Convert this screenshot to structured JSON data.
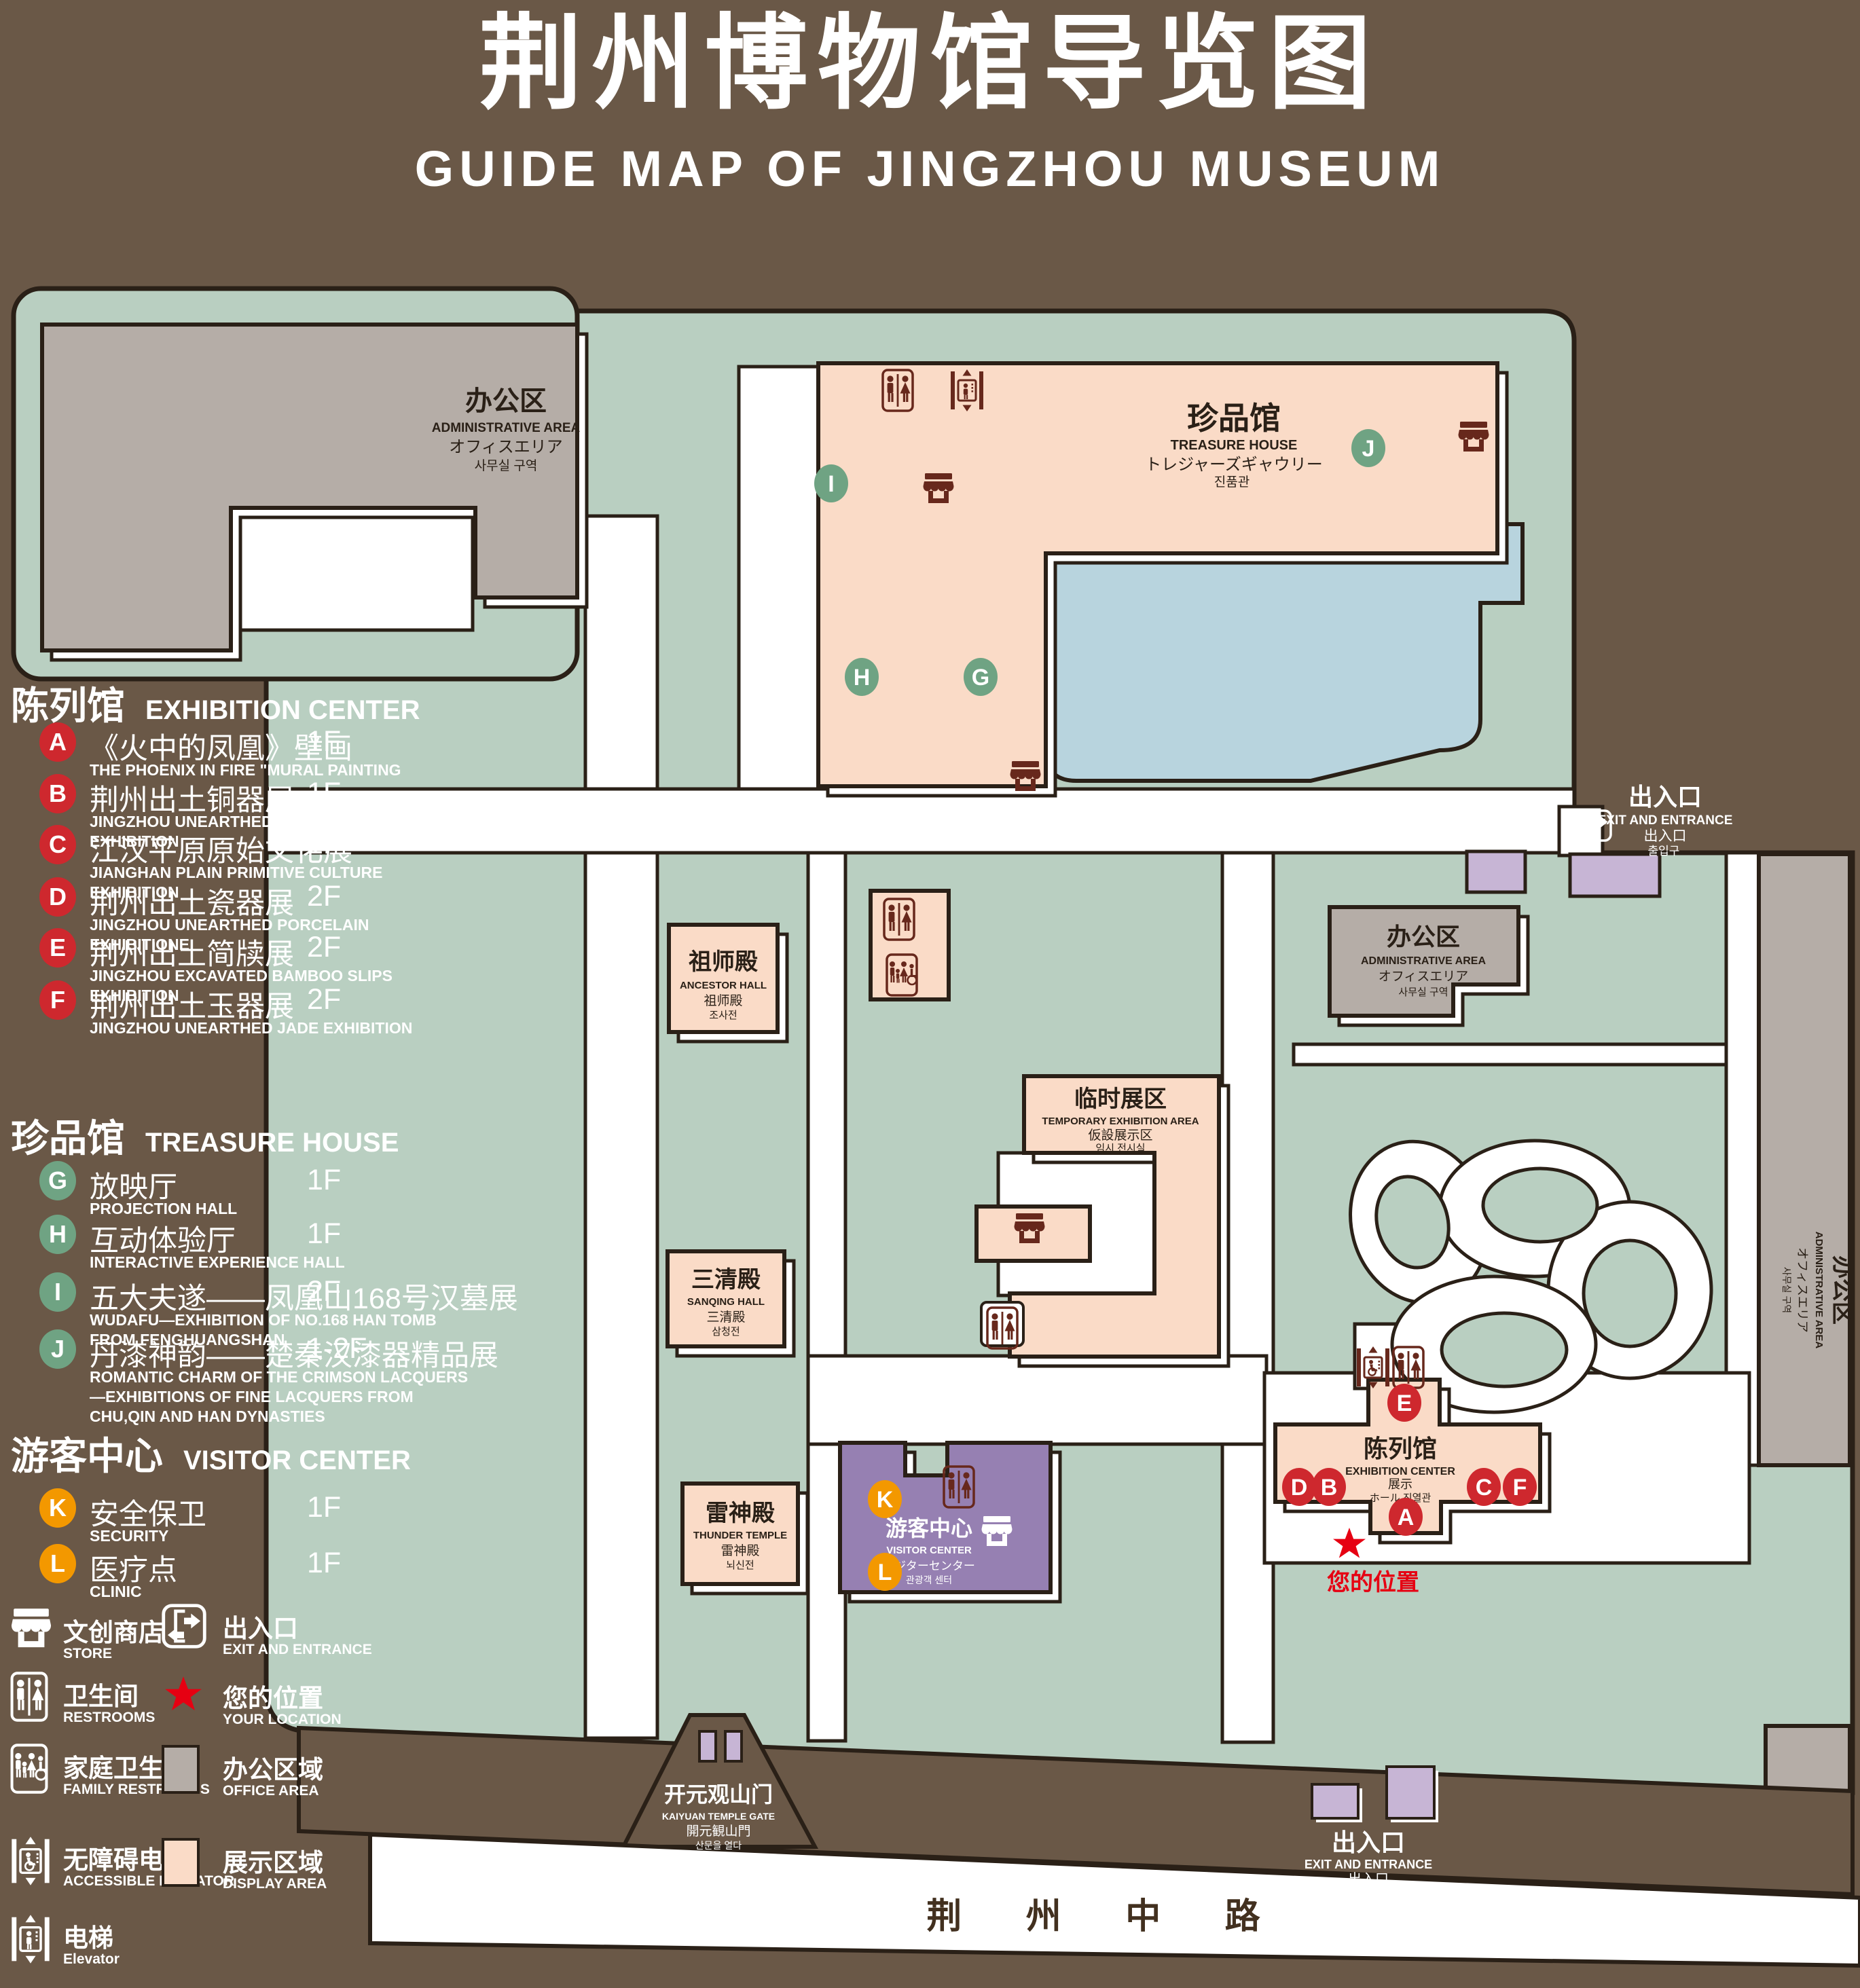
{
  "title": {
    "zh": "荆州博物馆导览图",
    "en": "GUIDE MAP OF JINGZHOU MUSEUM"
  },
  "legend_panel": {
    "sections": [
      {
        "zh": "陈列馆",
        "en": "EXHIBITION CENTER",
        "items": [
          {
            "key": "A",
            "zh": "《火中的凤凰》壁画",
            "en": "THE PHOENIX IN FIRE \"MURAL PAINTING",
            "floor": "1F"
          },
          {
            "key": "B",
            "zh": "荆州出土铜器展",
            "en": "JINGZHOU UNEARTHED BRONZE WARE EXHIBITION",
            "floor": "1F"
          },
          {
            "key": "C",
            "zh": "江汉平原原始文化展",
            "en": "JIANGHAN PLAIN PRIMITIVE CULTURE EXHIBITION",
            "floor": "1F"
          },
          {
            "key": "D",
            "zh": "荆州出土瓷器展",
            "en": "JINGZHOU UNEARTHED PORCELAIN EXHIBITIONE",
            "floor": "2F"
          },
          {
            "key": "E",
            "zh": "荆州出土简牍展",
            "en": "JINGZHOU EXCAVATED BAMBOO SLIPS EXHIBITION",
            "floor": "2F"
          },
          {
            "key": "F",
            "zh": "荆州出土玉器展",
            "en": "JINGZHOU UNEARTHED JADE EXHIBITION",
            "floor": "2F"
          }
        ]
      },
      {
        "zh": "珍品馆",
        "en": "TREASURE HOUSE",
        "items": [
          {
            "key": "G",
            "zh": "放映厅",
            "en": "PROJECTION HALL",
            "floor": "1F"
          },
          {
            "key": "H",
            "zh": "互动体验厅",
            "en": "INTERACTIVE EXPERIENCE HALL",
            "floor": "1F"
          },
          {
            "key": "I",
            "zh": "五大夫遂——凤凰山168号汉墓展",
            "en": "WUDAFU—EXHIBITION OF NO.168 HAN TOMB FROM FENGHUANGSHAN",
            "floor": "2F"
          },
          {
            "key": "J",
            "zh": "丹漆神韵——楚秦汉漆器精品展",
            "en": "ROMANTIC CHARM OF THE CRIMSON LACQUERS—EXHIBITIONS OF FINE LACQUERS FROM CHU,QIN AND HAN DYNASTIES",
            "floor": "1-2F"
          }
        ]
      },
      {
        "zh": "游客中心",
        "en": "VISITOR CENTER",
        "items": [
          {
            "key": "K",
            "zh": "安全保卫",
            "en": "SECURITY",
            "floor": "1F"
          },
          {
            "key": "L",
            "zh": "医疗点",
            "en": "CLINIC",
            "floor": "1F"
          }
        ]
      }
    ],
    "symbols": [
      {
        "icon": "store-icon",
        "zh": "文创商店",
        "en": "STORE"
      },
      {
        "icon": "exit-icon",
        "zh": "出入口",
        "en": "EXIT AND ENTRANCE"
      },
      {
        "icon": "restroom-icon",
        "zh": "卫生间",
        "en": "RESTROOMS"
      },
      {
        "icon": "location-star-icon",
        "zh": "您的位置",
        "en": "YOUR LOCATION"
      },
      {
        "icon": "family-restroom-icon",
        "zh": "家庭卫生间",
        "en": "FAMILY RESTROOMS"
      },
      {
        "icon": "office-area-swatch",
        "zh": "办公区域",
        "en": "OFFICE AREA"
      },
      {
        "icon": "accessible-elevator-icon",
        "zh": "无障碍电梯",
        "en": "ACCESSIBLE ELEVATOR"
      },
      {
        "icon": "display-area-swatch",
        "zh": "展示区域",
        "en": "DISPLAY AREA"
      },
      {
        "icon": "elevator-icon",
        "zh": "电梯",
        "en": "Elevator"
      }
    ]
  },
  "map": {
    "buildings": {
      "admin_tl": {
        "zh": "办公区",
        "en": "ADMINISTRATIVE AREA",
        "ja": "オフィスエリア",
        "ko": "사무실 구역"
      },
      "treasure_house": {
        "zh": "珍品馆",
        "en": "TREASURE HOUSE",
        "ja": "トレジャーズギャウリー",
        "ko": "진품관"
      },
      "admin_right": {
        "zh": "办公区",
        "en": "ADMINISTRATIVE AREA",
        "ja": "オフィスエリア",
        "ko": "사무실 구역"
      },
      "admin_strip": {
        "zh": "办公区",
        "en": "ADMINISTRATIVE AREA",
        "ja": "オフィスエリア",
        "ko": "사무실 구역"
      },
      "ancestor_hall": {
        "zh": "祖师殿",
        "en": "ANCESTOR HALL",
        "ja": "祖师殿",
        "ko": "조사전"
      },
      "temporary_exhibition": {
        "zh": "临时展区",
        "en": "TEMPORARY EXHIBITION AREA",
        "ja": "仮設展示区",
        "ko": "임시 전시실"
      },
      "sanqing_hall": {
        "zh": "三清殿",
        "en": "SANQING HALL",
        "ja": "三清殿",
        "ko": "삼청전"
      },
      "thunder_temple": {
        "zh": "雷神殿",
        "en": "THUNDER TEMPLE",
        "ja": "雷神殿",
        "ko": "뇌신전"
      },
      "visitor_center": {
        "zh": "游客中心",
        "en": "VISITOR CENTER",
        "ja": "ビジターセンター",
        "ko": "관광객 센터"
      },
      "exhibition_center": {
        "zh": "陈列馆",
        "en": "EXHIBITION CENTER",
        "ja": "展示",
        "ko": "ホール 진열관"
      },
      "kaiyuan_gate": {
        "zh": "开元观山门",
        "en": "KAIYUAN TEMPLE GATE",
        "ja": "開元観山門",
        "ko": "산문을 열다"
      }
    },
    "exits": {
      "top_right": {
        "zh": "出入口",
        "en": "EXIT AND ENTRANCE",
        "zh2": "出入口",
        "ko": "출입구"
      },
      "bottom_right": {
        "zh": "出入口",
        "en": "EXIT AND ENTRANCE",
        "zh2": "出入口",
        "ko": "출입구"
      }
    },
    "street": {
      "name": "荆 州 中 路"
    },
    "your_location": {
      "label": "您的位置"
    },
    "badges": {
      "A": "A",
      "B": "B",
      "C": "C",
      "D": "D",
      "E": "E",
      "F": "F",
      "G": "G",
      "H": "H",
      "I": "I",
      "J": "J",
      "K": "K",
      "L": "L"
    }
  },
  "colors": {
    "background": "#6A5847",
    "park_green": "#B9CFC1",
    "display_pink": "#FADBC7",
    "office_gray": "#B5ADA7",
    "visitor_purple": "#9680B2",
    "small_building_lavender": "#C7B5D5",
    "pond_blue": "#B8D4DE",
    "outline": "#2A2017",
    "badge_red": "#CE282E",
    "badge_green": "#6FA383",
    "badge_orange": "#F39800",
    "star_red": "#E60012",
    "icon_maroon": "#67281C"
  }
}
